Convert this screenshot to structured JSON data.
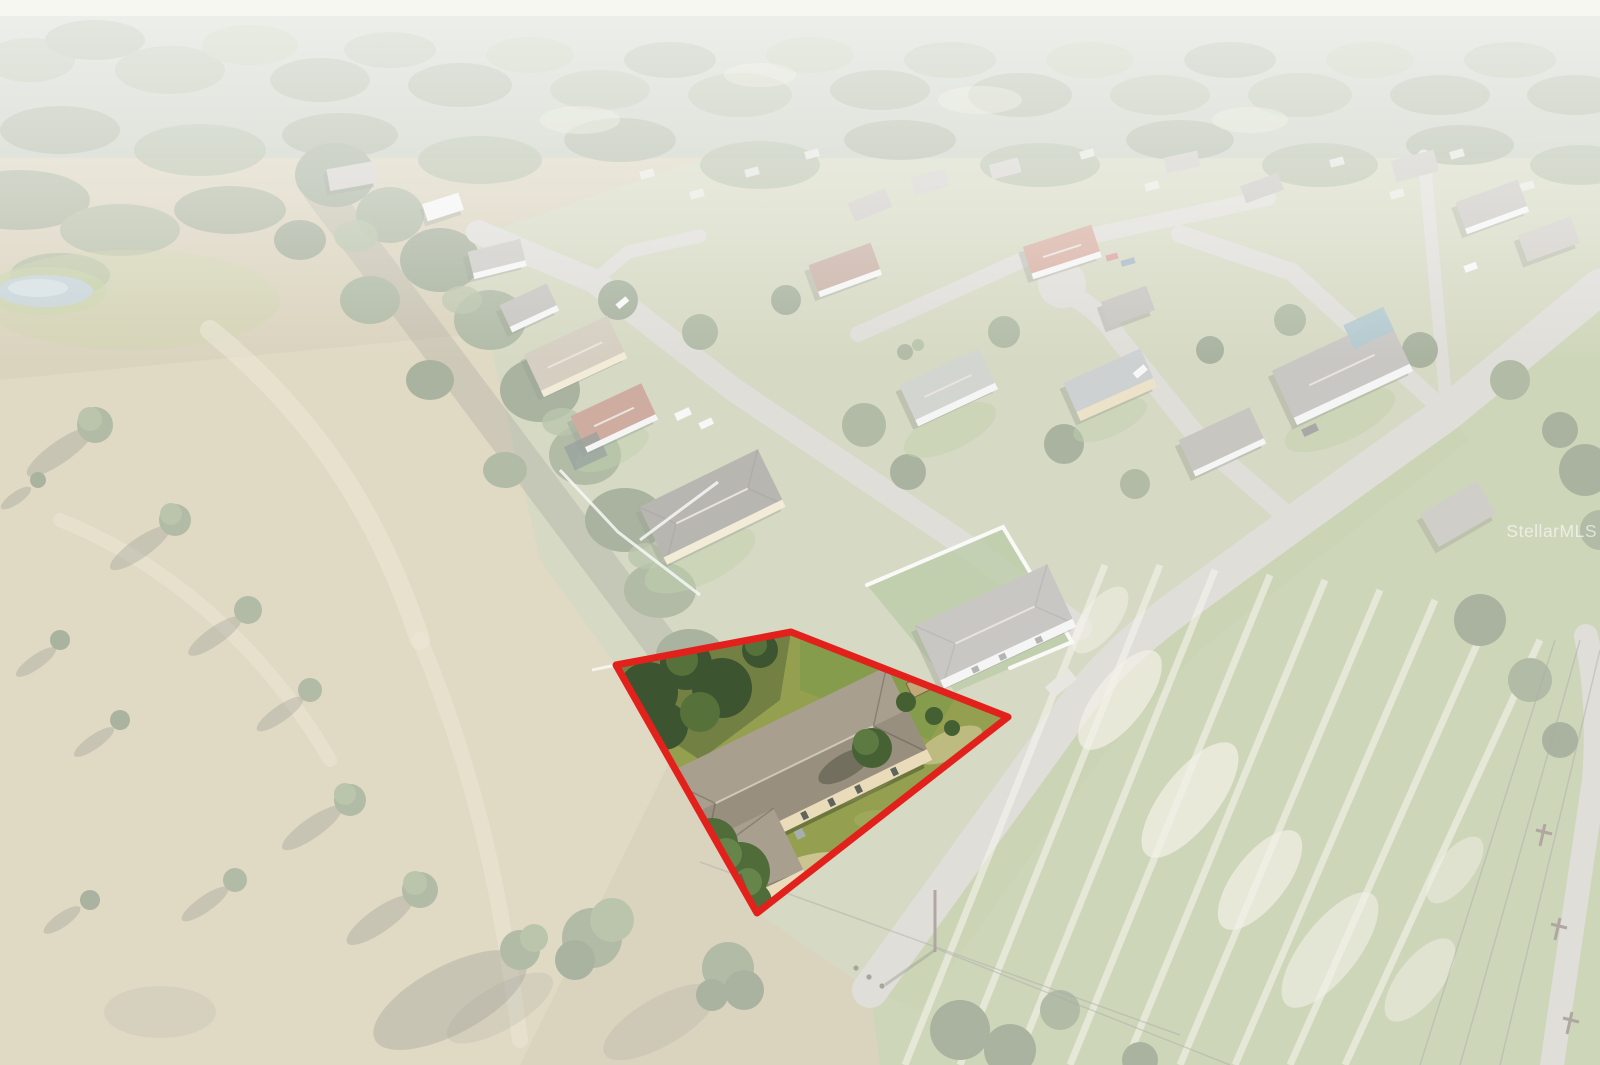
{
  "canvas": {
    "width": 1600,
    "height": 1065
  },
  "watermark": {
    "text": "StellarMLS",
    "color": "rgba(255,255,255,0.6)"
  },
  "lot_highlight": {
    "points": "616,665 791,632 1008,717 757,913",
    "outline_color": "#e3211c",
    "outline_width": "7"
  },
  "palette": {
    "haze": "#f7f7f2",
    "road": "#bdbab0",
    "field_dry": "#b3a478",
    "right_field": "#9aa96f",
    "forest": "#5d7245",
    "lot_grass": "#94a050",
    "subject_roof": "#a89f8e",
    "subject_wall": "#eadcba",
    "fence_white": "#f4f6f1",
    "pond": "#8fa7b0"
  }
}
